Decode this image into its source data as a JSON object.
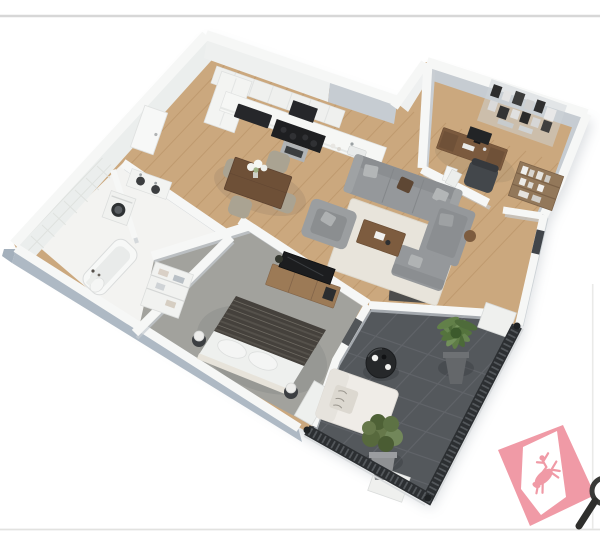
{
  "scene": {
    "kind": "3d-floor-plan-render",
    "subject": "isometric cutaway 3D floor plan of a one-bedroom apartment",
    "rooms": [
      {
        "name": "kitchen"
      },
      {
        "name": "dining-area"
      },
      {
        "name": "living-room"
      },
      {
        "name": "home-office"
      },
      {
        "name": "bedroom"
      },
      {
        "name": "bathroom"
      },
      {
        "name": "laundry-closet"
      },
      {
        "name": "balcony"
      }
    ],
    "watermark": {
      "symbol": "bucking-horse-and-rider",
      "color": "#f09aa6"
    },
    "cropped_object": "magnifying-glass-handle"
  },
  "palette": {
    "background": "#ffffff",
    "frame_line": "#d7d7d7",
    "frame_line_bottom": "#e2e2e0",
    "frame_line_right": "#eaeae8",
    "wall_white": "#f6f7f6",
    "interior_wall_face": "#c6ccd2",
    "exterior_wall_face": "#aeb9c4",
    "wood_floor": "#cba87e",
    "plank_line": "#b28a5e",
    "carpet": "#a2a29d",
    "bathroom_floor": "#f3f3f1",
    "balcony_tile": "#54585c",
    "balcony_grout": "#63676c",
    "railing": "#2c2f32",
    "rug": "#e8e4db",
    "sofa_gray": "#95989b",
    "coffee_table": "#7d5c3f",
    "dining_table": "#6e5037",
    "chair_beige": "#aaa392",
    "bed_duvet": "#45413c",
    "bed_linen": "#eef0ee",
    "desk_wood": "#7b5a3e",
    "console_wood": "#9c7a56",
    "tv_black": "#1c1d1f",
    "appliance_dark": "#26272a",
    "plant_green": "#5f7c47",
    "pot_gray": "#64676a",
    "watermark_pink": "#f09aa6",
    "magnifier_dark": "#3a3a38"
  }
}
